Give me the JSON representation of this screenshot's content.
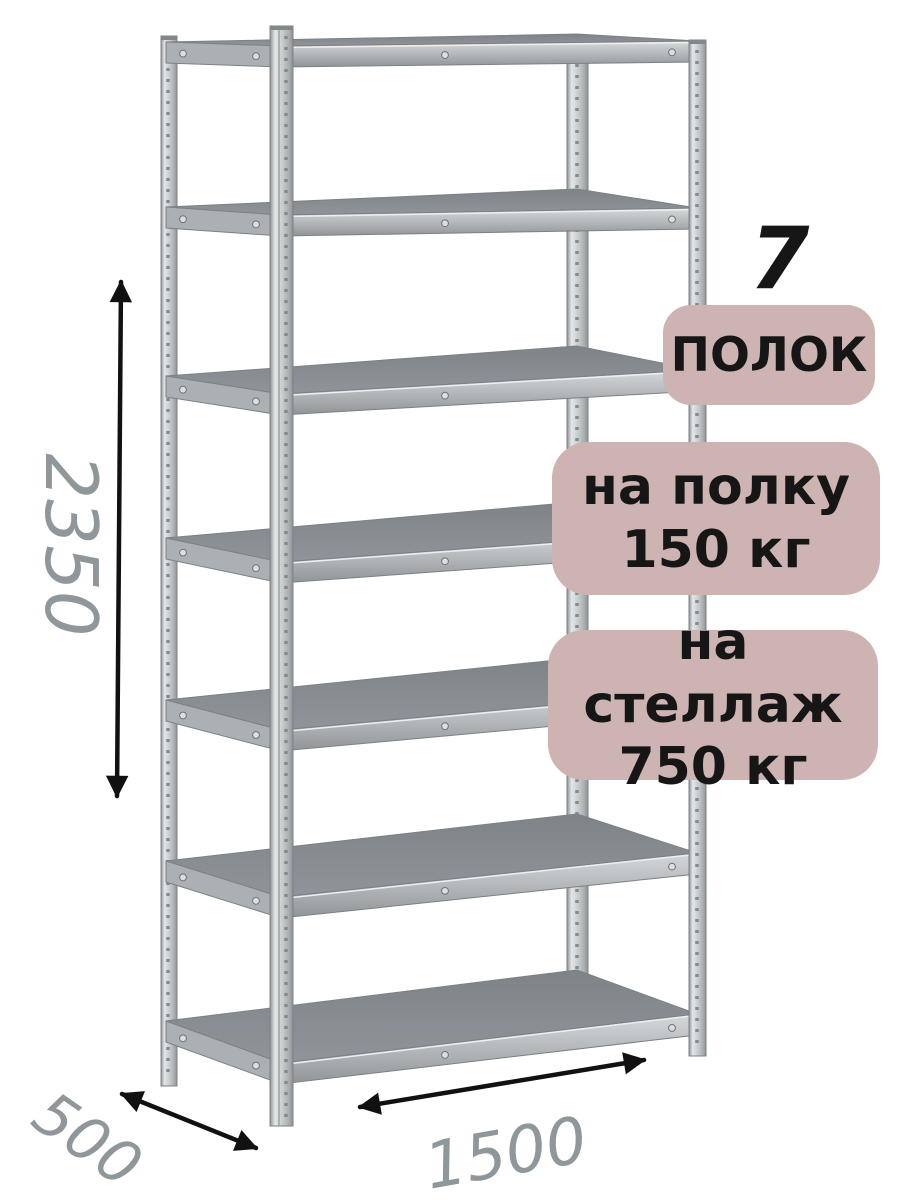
{
  "badges": {
    "shelf_count": {
      "number": "7",
      "label": "ПОЛОК"
    },
    "per_shelf": {
      "line1": "на полку",
      "line2": "150 кг"
    },
    "per_rack": {
      "line1": "на стеллаж",
      "line2": "750 кг"
    }
  },
  "dimensions": {
    "height": "2350",
    "width": "1500",
    "depth": "500"
  },
  "colors": {
    "badge_background": "#cdb3b2",
    "badge_text": "#161616",
    "dimension_text": "#8f979b",
    "arrow": "#111111",
    "metal_surface": "#8b9095",
    "metal_surface_dark": "#7e8388",
    "metal_band_light": "#d6d9da",
    "metal_band_mid": "#b4b8bb",
    "metal_band_dark": "#8f9497",
    "metal_edge": "#7d8184",
    "bolt_fill": "#dcdfe0"
  }
}
